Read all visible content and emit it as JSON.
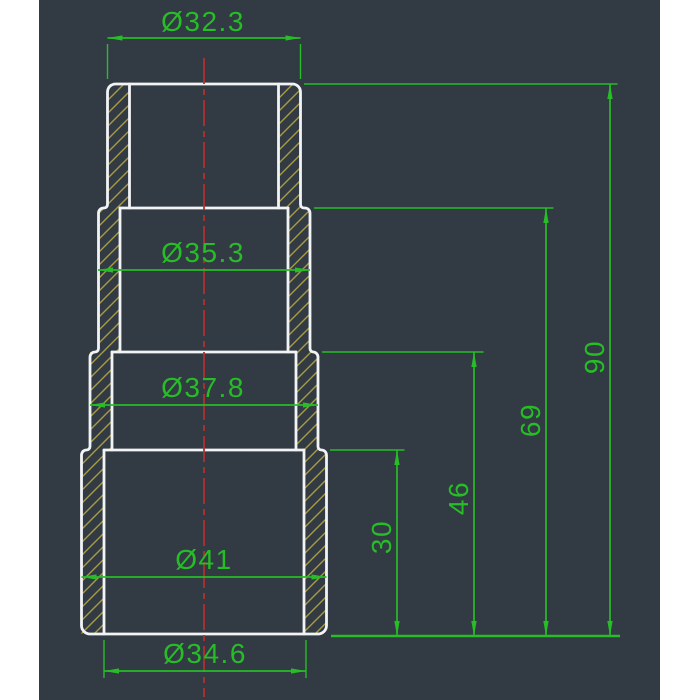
{
  "window": {
    "background_color": "#323a44",
    "margin_color": "#ffffff"
  },
  "drawing": {
    "description": "CAD section view of a stepped cylindrical hose adapter with four diameter steps",
    "colors": {
      "outline": "#f2f3f5",
      "dimension_green": "#26bd26",
      "centerline_red": "#b23030",
      "hatch_yellow": "#a79b43",
      "background": "#323a44"
    },
    "dims": {
      "diameters": [
        {
          "label": "Ø32.3",
          "value": 32.3,
          "location": "top section outer diameter"
        },
        {
          "label": "Ø35.3",
          "value": 35.3,
          "location": "second section outer diameter"
        },
        {
          "label": "Ø37.8",
          "value": 37.8,
          "location": "third section outer diameter"
        },
        {
          "label": "Ø41",
          "value": 41,
          "location": "bottom section outer diameter"
        },
        {
          "label": "Ø34.6",
          "value": 34.6,
          "location": "bottom opening inner diameter"
        }
      ],
      "lengths": [
        {
          "label": "90",
          "value": 90,
          "location": "total height"
        },
        {
          "label": "69",
          "value": 69,
          "location": "height to first step"
        },
        {
          "label": "46",
          "value": 46,
          "location": "height to second step"
        },
        {
          "label": "30",
          "value": 30,
          "location": "height to third step"
        }
      ]
    }
  }
}
